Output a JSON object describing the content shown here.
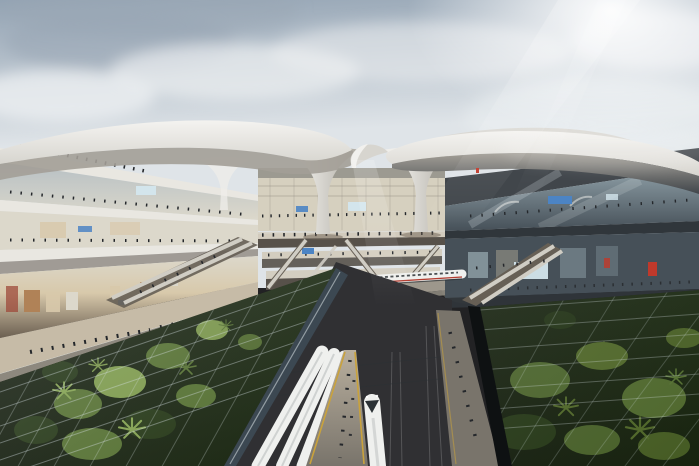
{
  "scene": {
    "description": "Architectural rendering of a futuristic high-speed rail station: a sweeping white shell canopy with an S-shaped oculus rests on sculptural funnel columns above a multi-level glazed atrium; crowds cross bridges and escalators between a sunlit glass gallery on the left and a darker glass gallery on the right; below, white high-speed trains wait at platforms with yellow safety lines beside an arched tunnel portal, a train crosses a mid-level viaduct, and sunken palm gardens sit beneath glass grid roofs in both lower corners under a soft cloudy sky with sun rays from the upper right.",
    "elements": {
      "sky": "cloudy sky with sun glare",
      "canopy": "white sweeping shell roof with S-curve oculus",
      "columns": "flared funnel columns",
      "left_building": "sunlit multi-storey glass gallery with shops and walkway",
      "right_building": "shaded dark glass gallery with illuminated displays",
      "atrium": "layered concourse bridges with crowds and escalators",
      "viaduct_train": "white high-speed train with red stripe on mid-level viaduct",
      "tunnel": "arched tunnel portal with warm interior glow",
      "platforms": "platforms with yellow edge lines, waiting trains and approaching train nose",
      "gardens": "sunken palm gardens under glass grid canopies"
    }
  },
  "colors": {
    "skyTop": "#93a3b3",
    "skyLow": "#dfe4e8",
    "cloudDark": "#98a6b3",
    "cloudLight": "#eceff1",
    "sunWhite": "#ffffff",
    "roofTop": "#f4f3f0",
    "roofMid": "#d7d5cf",
    "roofShadow": "#a39f97",
    "domeSilver": "#dbd9d4",
    "rightFascia": "#41464b",
    "funnelLight": "#efeeea",
    "funnelShade": "#aaa69d",
    "slabLight": "#e9e7e1",
    "slabShade": "#8d887e",
    "shadowWarm": "#6b5f51",
    "glassCool": "#b7c0c4",
    "glassLit": "#dcd8cb",
    "interiorWarm": "#d8c9ab",
    "retailWarm": "#b08257",
    "retailRed": "#9e4a3a",
    "darkSlab": "#30363b",
    "darkGlass": "#465058",
    "darkGlassLit": "#90a1a9",
    "screenBlue": "#4c84c4",
    "screenPale": "#d3e5ec",
    "accentRed": "#c0392b",
    "atriumBack": "#d6d0bf",
    "concourseFloor": "#d2cbbd",
    "concourseShade": "#57514a",
    "escalatorLight": "#d0cdc4",
    "escalatorDark": "#665f55",
    "ovalLight": "#968f82",
    "ovalDark": "#4a4a46",
    "viaductGray": "#9d978c",
    "parapet": "#b3ada2",
    "tunnelDark": "#151110",
    "tunnelGlow": "#8a6d45",
    "tunnelBright": "#d8b377",
    "trainWhite": "#eff0ee",
    "trainShade": "#c2c5c4",
    "trainStripe": "#b23c30",
    "windshield": "#2b3135",
    "groundDark": "#222224",
    "trackDark": "#303033",
    "platformLight": "#b9af9e",
    "platformShade": "#79746b",
    "yellowLine": "#c9a23c",
    "walkTan": "#c6bba7",
    "gardenBase": "#1c2a12",
    "gardenDeep": "#121b0b",
    "palmLight": "#82a04e",
    "palmMid": "#546f30",
    "palmDark": "#243615",
    "palmRight": "#4e6527",
    "gridLine": "#d3dde0",
    "glassSheen": "#eaf2f4",
    "wallGlass": "#3c4852",
    "fenceDark": "#0e1112",
    "peopleDark": "#24272b"
  }
}
